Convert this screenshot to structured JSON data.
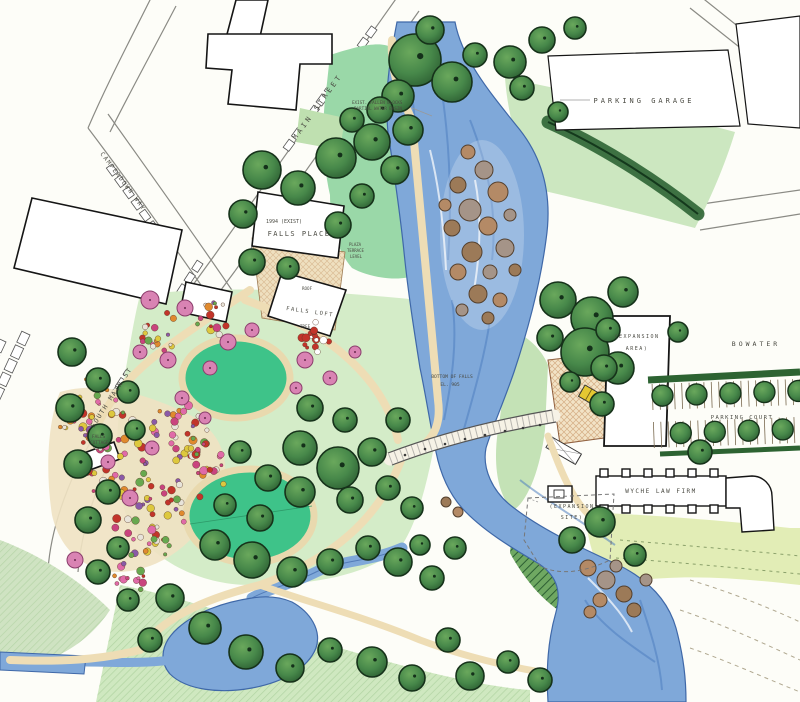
{
  "labels": {
    "main_street": "MAIN STREET",
    "camperdown_way": "CAMPERDOWN WAY",
    "south_main_st": "SOUTH MAIN ST",
    "parking_garage": "PARKING GARAGE",
    "bowater": "BOWATER",
    "expansion_area_line1": "(EXPANSION",
    "expansion_area_line2": "AREA)",
    "parking_court": "PARKING COURT",
    "wyche_law_firm": "WYCHE LAW FIRM",
    "expansion_site_line1": "(EXPANSION",
    "expansion_site_line2": "SITE)",
    "falls_place": "FALLS PLACE",
    "falls_place_note": "1994 (EXIST)",
    "falls_loft": "FALLS LOFT",
    "roof_note": "ROOF",
    "tree_note": "TREE",
    "falls_cottage_line1": "FALLS",
    "falls_cottage_line2": "COTTAGE",
    "bottom_of_falls_line1": "BOTTOM OF FALLS",
    "bottom_of_falls_line2": "EL. 905",
    "river_note_line1": "EXIST. FALLEN BLOCKS",
    "river_note_line2": "PARTIAL WATER BASIN",
    "terrace_note_line1": "PLAZA",
    "terrace_note_line2": "TERRACE",
    "terrace_note_line3": "LEVEL"
  },
  "colors": {
    "paper": "#fdfdf8",
    "river": "#7fa8d9",
    "river_dark": "#4f7fc0",
    "tree": "#3a7d3f",
    "lawn": "#3ec389",
    "park_green": "#d4ecc8",
    "path_tan": "#eeddb5",
    "rock_brown": "#b48a66",
    "trellis_yellow": "#e5c832"
  }
}
